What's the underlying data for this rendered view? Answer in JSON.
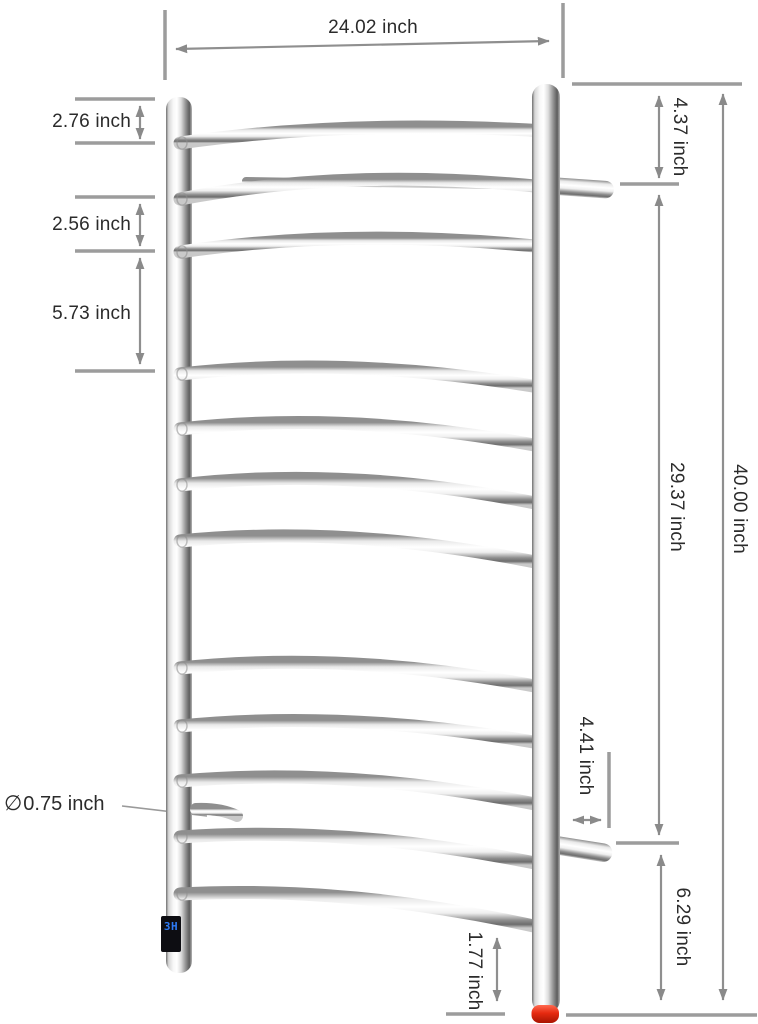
{
  "product": {
    "type": "curved-towel-warmer-diagram",
    "display_readout": "3H"
  },
  "labels": {
    "top_width": "24.02 inch",
    "gap_post_top_to_rail1": "2.76 inch",
    "gap_rail2_to_rail3": "2.56 inch",
    "gap_rail3_to_rail4": "5.73 inch",
    "top_to_upper_bracket": "4.37 inch",
    "upper_to_lower_bracket": "29.37 inch",
    "overall_height": "40.00 inch",
    "bracket_depth": "4.41 inch",
    "lower_bracket_to_floor": "6.29 inch",
    "rail_bottom_clearance": "1.77 inch",
    "diameter_symbol": "∅",
    "tube_diameter": "0.75 inch"
  },
  "colors": {
    "dimension_line": "#9c9c9c",
    "arrow": "#8a8a8a",
    "label_text": "#2b2b2b",
    "display_text": "#2e7bf6",
    "foot_cap": "#d9260f"
  }
}
